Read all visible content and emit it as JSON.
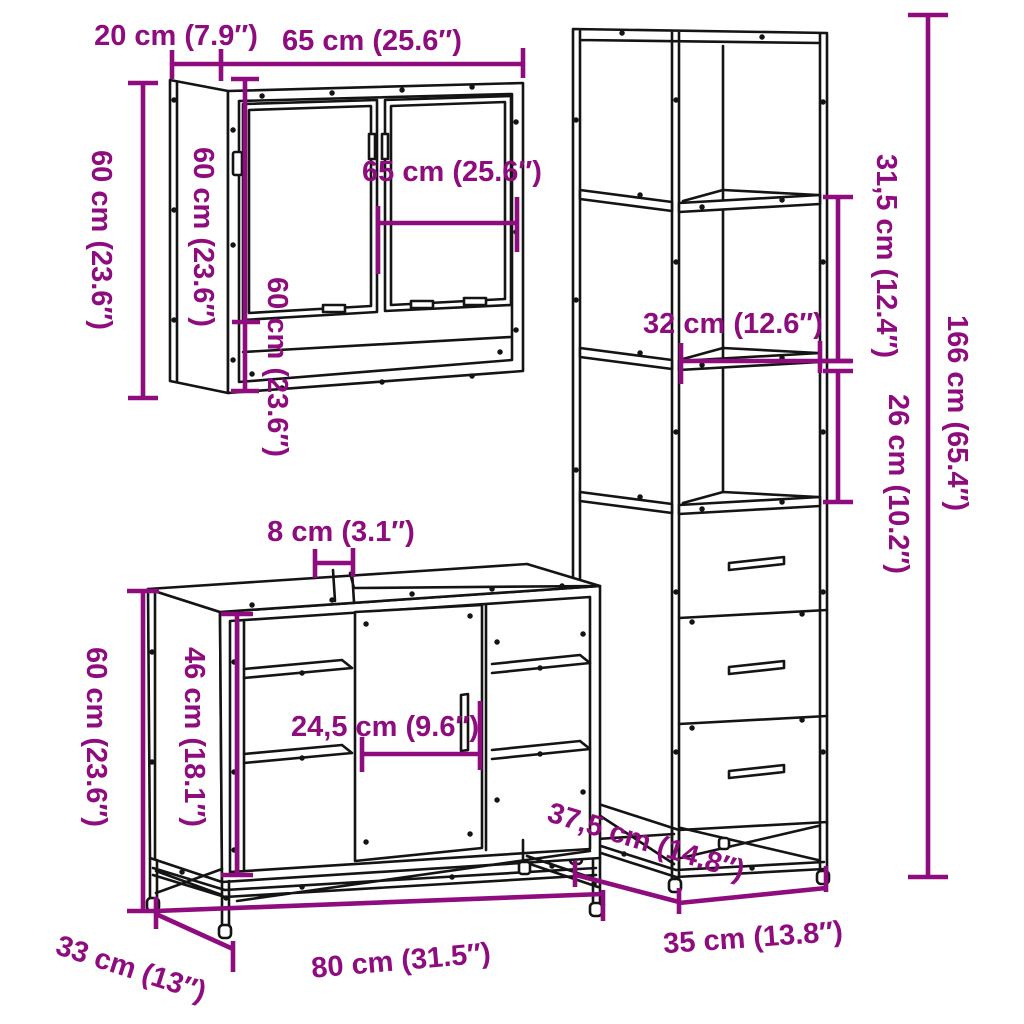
{
  "diagram": {
    "type": "furniture-dimension-diagram",
    "piece_count": 3,
    "colors": {
      "dimension_annotation": "#8E0C7D",
      "line_art": "#141414",
      "background": "#FFFFFF"
    },
    "mirror_cabinet": {
      "name": "mirror cabinet",
      "depth_label": "20 cm (7.9″)",
      "width_label": "65 cm (25.6″)",
      "height_label": "60 cm (23.6″)",
      "height_side_label": "60 cm (23.6″)",
      "height_front_label": "60 cm (23.6″)",
      "inner_width_label": "65 cm (25.6″)",
      "depth_cm": 20,
      "width_cm": 65,
      "height_cm": 60
    },
    "tall_cabinet": {
      "name": "tall storage cabinet",
      "height_label": "166 cm (65.4″)",
      "upper_compartment_label": "31,5 cm (12.4″)",
      "lower_compartment_label": "26 cm (10.2″)",
      "inner_width_label": "32 cm (12.6″)",
      "depth_label": "37,5 cm (14.8″)",
      "width_label": "35 cm (13.8″)",
      "width_cm": 35,
      "depth_cm": 37.5,
      "height_cm": 166,
      "drawer_count": 3
    },
    "vanity_cabinet": {
      "name": "bathroom sink cabinet",
      "gap_label": "8 cm (3.1″)",
      "height_label": "60 cm (23.6″)",
      "inner_height_label": "46 cm (18.1″)",
      "inner_width_label": "24,5 cm (9.6″)",
      "depth_label": "33 cm (13″)",
      "width_label": "80 cm (31.5″)",
      "width_cm": 80,
      "depth_cm": 33,
      "height_cm": 60
    }
  }
}
